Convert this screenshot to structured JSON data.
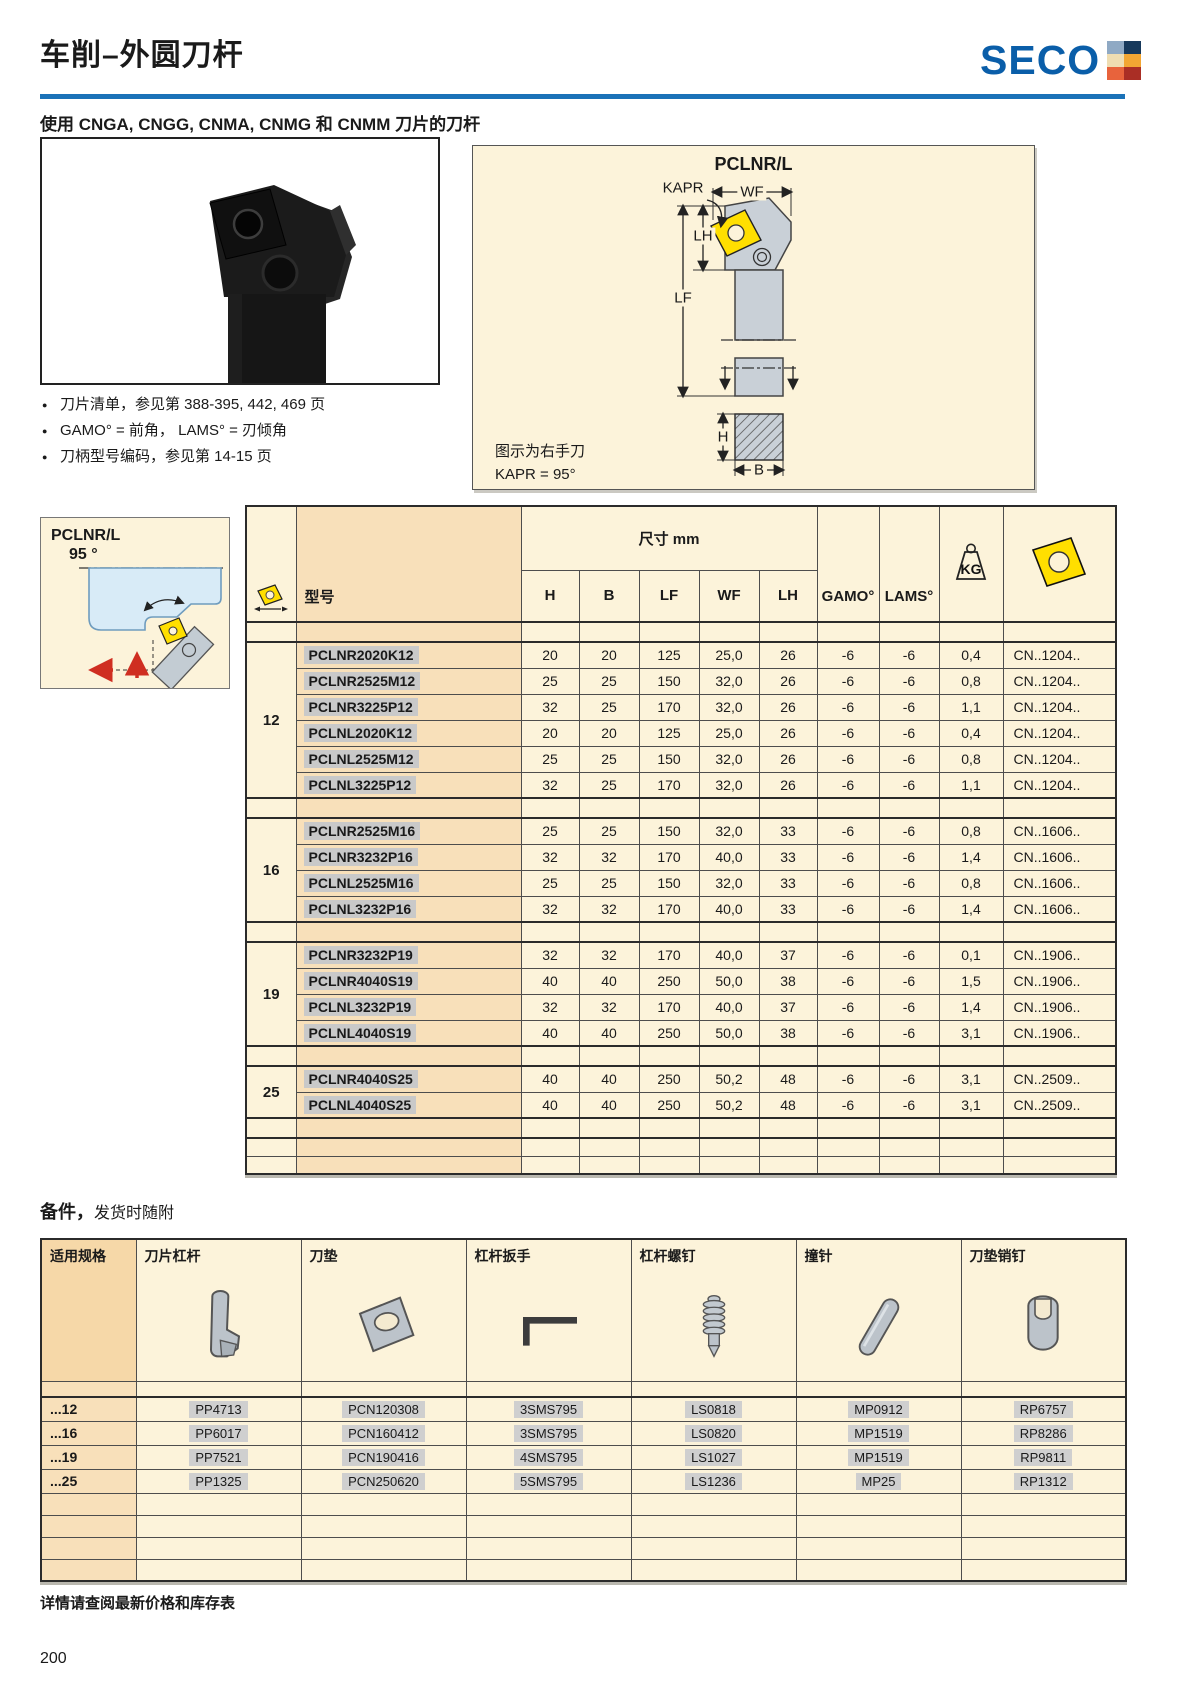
{
  "page": {
    "title": "车削–外圆刀杆",
    "subtitle": "使用 CNGA, CNGG, CNMA, CNMG 和 CNMM 刀片的刀杆",
    "footer_note": "详情请查阅最新价格和库存表",
    "page_number": "200"
  },
  "logo": {
    "text": "SECO",
    "squares": [
      "#8fa9c4",
      "#17395c",
      "#efddb2",
      "#f2a633",
      "#e8633c",
      "#aa2e25"
    ]
  },
  "colors": {
    "rule_blue": "#1b72b8",
    "logo_blue": "#0a5ea9",
    "cream": "#fcf3da",
    "peach": "#f8e0ba",
    "peach_dark": "#f6d8a8",
    "insert_yellow": "#ffdf00",
    "highlight_gray": "#c9c9c9",
    "red_arrow": "#cf2e21"
  },
  "notes": [
    "刀片清单，参见第 388-395, 442, 469 页",
    "GAMO° = 前角， LAMS° = 刃倾角",
    "刀柄型号编码，参见第 14-15 页"
  ],
  "diagram": {
    "title": "PCLNR/L",
    "labels": {
      "wf": "WF",
      "kapr": "KAPR",
      "lh": "LH",
      "lf": "LF",
      "h": "H",
      "b": "B"
    },
    "caption1": "图示为右手刀",
    "caption2": "KAPR = 95°"
  },
  "side_diagram": {
    "title": "PCLNR/L",
    "angle": "95 °"
  },
  "main_table": {
    "header": {
      "dims": "尺寸 mm",
      "model": "型号",
      "dim_cols": [
        "H",
        "B",
        "LF",
        "WF",
        "LH"
      ],
      "gamo": "GAMO°",
      "lams": "LAMS°",
      "kg": "KG"
    },
    "groups": [
      {
        "size": "12",
        "insert": "CN..1204..",
        "rows": [
          [
            "PCLNR2020K12",
            "20",
            "20",
            "125",
            "25,0",
            "26",
            "-6",
            "-6",
            "0,4"
          ],
          [
            "PCLNR2525M12",
            "25",
            "25",
            "150",
            "32,0",
            "26",
            "-6",
            "-6",
            "0,8"
          ],
          [
            "PCLNR3225P12",
            "32",
            "25",
            "170",
            "32,0",
            "26",
            "-6",
            "-6",
            "1,1"
          ],
          [
            "PCLNL2020K12",
            "20",
            "20",
            "125",
            "25,0",
            "26",
            "-6",
            "-6",
            "0,4"
          ],
          [
            "PCLNL2525M12",
            "25",
            "25",
            "150",
            "32,0",
            "26",
            "-6",
            "-6",
            "0,8"
          ],
          [
            "PCLNL3225P12",
            "32",
            "25",
            "170",
            "32,0",
            "26",
            "-6",
            "-6",
            "1,1"
          ]
        ]
      },
      {
        "size": "16",
        "insert": "CN..1606..",
        "rows": [
          [
            "PCLNR2525M16",
            "25",
            "25",
            "150",
            "32,0",
            "33",
            "-6",
            "-6",
            "0,8"
          ],
          [
            "PCLNR3232P16",
            "32",
            "32",
            "170",
            "40,0",
            "33",
            "-6",
            "-6",
            "1,4"
          ],
          [
            "PCLNL2525M16",
            "25",
            "25",
            "150",
            "32,0",
            "33",
            "-6",
            "-6",
            "0,8"
          ],
          [
            "PCLNL3232P16",
            "32",
            "32",
            "170",
            "40,0",
            "33",
            "-6",
            "-6",
            "1,4"
          ]
        ]
      },
      {
        "size": "19",
        "insert": "CN..1906..",
        "rows": [
          [
            "PCLNR3232P19",
            "32",
            "32",
            "170",
            "40,0",
            "37",
            "-6",
            "-6",
            "0,1"
          ],
          [
            "PCLNR4040S19",
            "40",
            "40",
            "250",
            "50,0",
            "38",
            "-6",
            "-6",
            "1,5"
          ],
          [
            "PCLNL3232P19",
            "32",
            "32",
            "170",
            "40,0",
            "37",
            "-6",
            "-6",
            "1,4"
          ],
          [
            "PCLNL4040S19",
            "40",
            "40",
            "250",
            "50,0",
            "38",
            "-6",
            "-6",
            "3,1"
          ]
        ]
      },
      {
        "size": "25",
        "insert": "CN..2509..",
        "rows": [
          [
            "PCLNR4040S25",
            "40",
            "40",
            "250",
            "50,2",
            "48",
            "-6",
            "-6",
            "3,1"
          ],
          [
            "PCLNL4040S25",
            "40",
            "40",
            "250",
            "50,2",
            "48",
            "-6",
            "-6",
            "3,1"
          ]
        ]
      }
    ],
    "trailing_empty_rows": 3
  },
  "spares": {
    "title_bold": "备件，",
    "title_rest": "发货时随附",
    "headers": [
      "适用规格",
      "刀片杠杆",
      "刀垫",
      "杠杆扳手",
      "杠杆螺钉",
      "撞针",
      "刀垫销钉"
    ],
    "icons": [
      "insert-lever-icon",
      "shim-icon",
      "wrench-icon",
      "lever-screw-icon",
      "pin-icon",
      "shim-pin-icon"
    ],
    "rows": [
      {
        "size": "...12",
        "values": [
          "PP4713",
          "PCN120308",
          "3SMS795",
          "LS0818",
          "MP0912",
          "RP6757"
        ]
      },
      {
        "size": "...16",
        "values": [
          "PP6017",
          "PCN160412",
          "3SMS795",
          "LS0820",
          "MP1519",
          "RP8286"
        ]
      },
      {
        "size": "...19",
        "values": [
          "PP7521",
          "PCN190416",
          "4SMS795",
          "LS1027",
          "MP1519",
          "RP9811"
        ]
      },
      {
        "size": "...25",
        "values": [
          "PP1325",
          "PCN250620",
          "5SMS795",
          "LS1236",
          "MP25",
          "RP1312"
        ]
      }
    ],
    "trailing_empty_rows": 4
  }
}
